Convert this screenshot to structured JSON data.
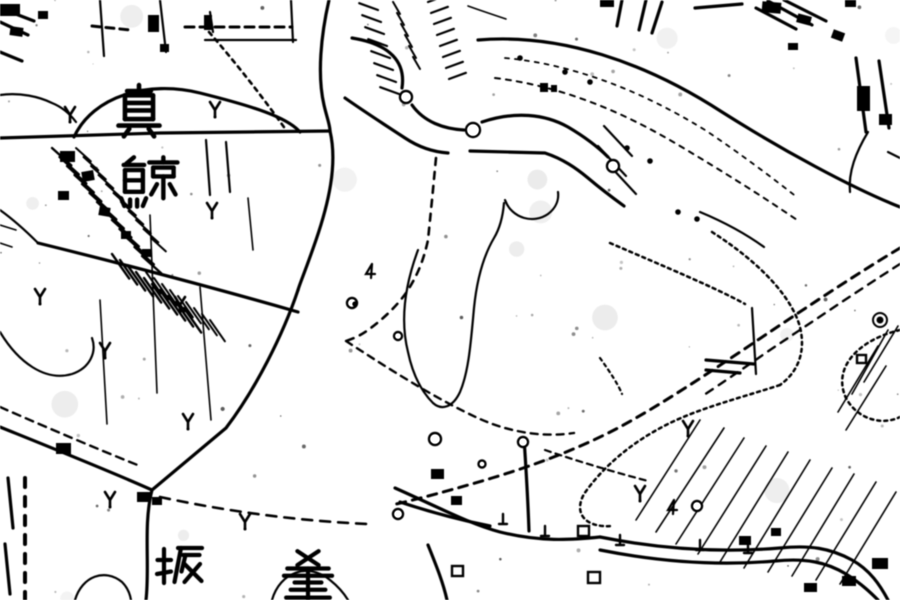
{
  "map": {
    "type": "scanned-monochrome-topographic-map",
    "background": "#ffffff",
    "ink": "#1b1b1b",
    "labels": [
      {
        "text": "眞",
        "x": 112,
        "y": 84,
        "size": 54,
        "w": 4.6,
        "strokes": [
          [
            50,
            2,
            50,
            13
          ],
          [
            28,
            13,
            72,
            13
          ],
          [
            24,
            21,
            76,
            21
          ],
          [
            24,
            21,
            24,
            65
          ],
          [
            76,
            21,
            76,
            65
          ],
          [
            28,
            35,
            72,
            35
          ],
          [
            28,
            49,
            72,
            49
          ],
          [
            24,
            65,
            76,
            65
          ],
          [
            12,
            77,
            88,
            77
          ],
          [
            32,
            83,
            22,
            97
          ],
          [
            68,
            83,
            78,
            97
          ]
        ]
      },
      {
        "text": "鯨",
        "x": 116,
        "y": 156,
        "size": 64,
        "w": 4.4,
        "strokes": [
          [
            28,
            2,
            16,
            12
          ],
          [
            12,
            14,
            44,
            14
          ],
          [
            14,
            22,
            14,
            56
          ],
          [
            42,
            22,
            42,
            56
          ],
          [
            14,
            22,
            42,
            22
          ],
          [
            14,
            38,
            42,
            38
          ],
          [
            14,
            56,
            42,
            56
          ],
          [
            8,
            66,
            13,
            78
          ],
          [
            22,
            68,
            22,
            79
          ],
          [
            33,
            68,
            33,
            79
          ],
          [
            47,
            66,
            42,
            78
          ],
          [
            52,
            10,
            96,
            10
          ],
          [
            74,
            2,
            74,
            10
          ],
          [
            58,
            18,
            90,
            18
          ],
          [
            58,
            18,
            58,
            32
          ],
          [
            90,
            18,
            90,
            32
          ],
          [
            58,
            32,
            90,
            32
          ],
          [
            74,
            32,
            74,
            66
          ],
          [
            64,
            44,
            55,
            60
          ],
          [
            84,
            44,
            93,
            60
          ]
        ]
      },
      {
        "text": "坂",
        "x": 156,
        "y": 543,
        "size": 50,
        "w": 4.2,
        "strokes": [
          [
            16,
            12,
            16,
            80
          ],
          [
            3,
            34,
            30,
            34
          ],
          [
            2,
            62,
            30,
            57
          ],
          [
            44,
            10,
            92,
            10
          ],
          [
            50,
            10,
            37,
            78
          ],
          [
            54,
            24,
            87,
            24
          ],
          [
            59,
            24,
            51,
            57
          ],
          [
            55,
            40,
            91,
            76
          ],
          [
            88,
            42,
            57,
            78
          ]
        ]
      },
      {
        "text": "釜",
        "x": 280,
        "y": 550,
        "size": 56,
        "w": 4.2,
        "strokes": [
          [
            31,
            2,
            69,
            27
          ],
          [
            69,
            2,
            31,
            27
          ],
          [
            13,
            33,
            87,
            33
          ],
          [
            50,
            33,
            50,
            88
          ],
          [
            7,
            46,
            93,
            46
          ],
          [
            26,
            58,
            74,
            58
          ],
          [
            19,
            71,
            81,
            71
          ],
          [
            11,
            85,
            89,
            85
          ]
        ]
      }
    ],
    "mulberry_symbols": [
      [
        70,
        114
      ],
      [
        215,
        109
      ],
      [
        212,
        210
      ],
      [
        40,
        296
      ],
      [
        105,
        350
      ],
      [
        180,
        304
      ],
      [
        188,
        421
      ],
      [
        110,
        499
      ],
      [
        245,
        521
      ],
      [
        640,
        493
      ],
      [
        688,
        428
      ]
    ],
    "circle_symbols": [
      [
        406,
        97,
        6
      ],
      [
        473,
        130,
        7
      ],
      [
        613,
        166,
        6
      ],
      [
        352,
        303,
        5
      ],
      [
        398,
        336,
        4
      ],
      [
        435,
        439,
        6
      ],
      [
        523,
        442,
        5
      ],
      [
        482,
        464,
        3.5
      ],
      [
        398,
        514,
        5
      ],
      [
        697,
        506,
        5
      ]
    ],
    "ring_dot_symbols": [
      [
        880,
        320
      ]
    ],
    "dot_symbols": [
      [
        678,
        212
      ],
      [
        697,
        219
      ],
      [
        650,
        161
      ],
      [
        545,
        88
      ],
      [
        355,
        304
      ],
      [
        520,
        58
      ],
      [
        565,
        72
      ],
      [
        590,
        82
      ],
      [
        627,
        148
      ]
    ],
    "square_symbols": [
      [
        578,
        526,
        11,
        10
      ],
      [
        588,
        572,
        12,
        11
      ],
      [
        452,
        566,
        11,
        10
      ],
      [
        857,
        355,
        9,
        8
      ]
    ],
    "four_symbols": [
      [
        370,
        272
      ],
      [
        672,
        508
      ]
    ],
    "tick_symbols": [
      [
        503,
        520
      ],
      [
        545,
        532
      ],
      [
        620,
        541
      ],
      [
        700,
        546
      ],
      [
        748,
        549
      ]
    ],
    "buildings": [
      [
        0,
        4,
        20,
        12,
        0
      ],
      [
        10,
        27,
        13,
        9,
        8
      ],
      [
        38,
        11,
        10,
        8,
        0
      ],
      [
        148,
        15,
        11,
        17,
        0
      ],
      [
        204,
        15,
        8,
        15,
        0
      ],
      [
        160,
        44,
        9,
        8,
        0
      ],
      [
        60,
        151,
        15,
        11,
        0
      ],
      [
        82,
        171,
        12,
        10,
        -10
      ],
      [
        58,
        191,
        11,
        9,
        0
      ],
      [
        99,
        207,
        11,
        9,
        10
      ],
      [
        121,
        231,
        10,
        8,
        0
      ],
      [
        142,
        249,
        9,
        8,
        0
      ],
      [
        56,
        443,
        15,
        11,
        0
      ],
      [
        600,
        0,
        14,
        7,
        0
      ],
      [
        845,
        0,
        11,
        7,
        0
      ],
      [
        762,
        2,
        19,
        11,
        5
      ],
      [
        797,
        15,
        14,
        9,
        15
      ],
      [
        832,
        31,
        12,
        9,
        20
      ],
      [
        788,
        43,
        10,
        7,
        0
      ],
      [
        857,
        86,
        13,
        25,
        0
      ],
      [
        879,
        114,
        13,
        11,
        0
      ],
      [
        872,
        558,
        16,
        11,
        0
      ],
      [
        842,
        576,
        14,
        10,
        0
      ],
      [
        804,
        583,
        13,
        9,
        0
      ],
      [
        739,
        536,
        12,
        9,
        0
      ],
      [
        771,
        528,
        10,
        8,
        0
      ],
      [
        431,
        469,
        13,
        10,
        0
      ],
      [
        451,
        496,
        11,
        9,
        0
      ],
      [
        540,
        83,
        8,
        9,
        0
      ],
      [
        551,
        85,
        6,
        7,
        0
      ],
      [
        137,
        492,
        14,
        10,
        0
      ],
      [
        152,
        497,
        10,
        8,
        0
      ]
    ],
    "bold_paths": [
      "M0,138 L160,133 L330,131",
      "M329,0 C321,35 317,75 324,105 C327,118 330,125 330,131",
      "M330,131 C338,165 328,205 316,240 C305,272 300,283 298,290",
      "M298,290 C283,335 255,390 226,428 L152,490",
      "M152,490 C112,472 52,448 0,427",
      "M152,490 C143,525 150,565 146,600",
      "M74,137 C93,96 148,80 200,93 C252,106 287,117 300,132",
      "M38,243 C115,262 215,288 298,312",
      "M478,40 C560,33 645,62 722,112 C782,150 852,188 900,207",
      "M470,151 L545,153 C563,159 576,168 588,178 C601,189 613,198 624,206",
      "M482,122 C515,111 545,114 568,127 C585,137 598,147 608,157",
      "M345,98 C365,112 385,125 405,138 C420,148 434,152 448,153",
      "M412,105 C424,122 444,129 464,130",
      "M352,38 C390,44 406,62 402,88",
      "M395,488 C440,508 470,524 500,532 C540,542 570,540 600,537",
      "M600,537 C660,549 720,553 780,548 C810,545 830,548 852,560 C870,570 880,585 888,600",
      "M600,550 C660,562 718,566 775,561 C806,558 826,562 846,574 C862,584 872,594 878,600",
      "M524,438 C526,468 528,502 529,531",
      "M428,545 C436,565 443,582 447,600",
      "M400,502 C430,512 460,520 490,526",
      "M706,360 L754,364",
      "M706,370 L740,373",
      "M0,8 L34,21",
      "M0,22 L28,35",
      "M0,52 L22,61",
      "M622,0 L617,26",
      "M646,0 L639,30",
      "M662,2 L652,33",
      "M695,8 L742,4",
      "M756,8 L796,29",
      "M768,1 L812,25",
      "M784,0 L826,21",
      "M856,58 L866,132",
      "M879,61 L889,128",
      "M8,478 L13,528",
      "M5,544 L10,594"
    ],
    "mid_paths": [
      "M205,40 L296,40",
      "M291,0 L293,42",
      "M0,332 C18,362 45,382 72,374 C90,368 97,352 92,338",
      "M75,600 C82,576 105,568 122,582 C128,588 130,594 131,600",
      "M272,600 C280,572 308,562 330,580 C340,588 345,595 348,600",
      "M0,210 C14,220 27,232 38,243",
      "M868,132 C856,152 848,172 850,192",
      "M700,212 C724,222 746,234 764,247",
      "M752,308 L756,374",
      "M206,140 L210,195",
      "M226,142 L230,192",
      "M418,250 C405,285 400,320 408,352 C413,376 422,392 433,403 C442,411 453,407 460,392 C469,371 471,340 474,308 C477,278 484,255 494,238 C500,228 503,215 504,203",
      "M505,200 C512,219 534,224 548,214 C556,208 559,200 558,192",
      "M0,95 C20,92 40,97 52,103 C62,107 70,114 76,122",
      "M100,0 L104,56",
      "M160,0 L166,52",
      "M210,12 L213,32",
      "M888,152 L900,158",
      "M604,126 L632,156 M598,146 L626,176 M610,166 L636,194"
    ],
    "thin_paths": [
      "M150,215 L157,393",
      "M200,287 L211,420",
      "M100,300 L107,424",
      "M248,198 L253,250",
      "M468,6 C482,11 494,15 506,19",
      "M0,225 L16,230 M0,243 L12,247",
      "M636,520 L700,420 M656,532 L724,428 M676,544 L744,438 M698,554 L766,446 M720,562 L788,452 M744,568 L810,460 M768,572 L832,468 M792,576 L854,474 M816,580 L876,482 M840,584 L896,492",
      "M852,394 L888,330 M838,412 L878,346 M864,382 L898,326 M846,430 L886,366"
    ],
    "dashed_paths": [
      {
        "d": "M900,248 C850,278 795,315 740,352 C695,382 655,408 618,428 C576,450 532,466 492,478 C452,490 418,499 392,505",
        "w": 3,
        "dash": "9 7"
      },
      {
        "d": "M900,264 C856,292 812,322 770,350 C744,368 722,383 704,395",
        "w": 2.4,
        "dash": "8 7"
      },
      {
        "d": "M160,497 C230,512 300,521 368,524",
        "w": 2.6,
        "dash": "10 8"
      },
      {
        "d": "M436,158 L432,200 L428,240 C423,263 416,278 406,293 C396,307 382,320 368,330 C360,336 352,339 346,341",
        "w": 2.6,
        "dash": "7 7"
      },
      {
        "d": "M346,341 C395,373 442,402 480,419 C514,434 547,437 574,433",
        "w": 2.4,
        "dash": "7 6"
      },
      {
        "d": "M209,32 C235,62 262,96 286,130",
        "w": 2.6,
        "dash": "4 5"
      },
      {
        "d": "M185,27 L292,27",
        "w": 3,
        "dash": "9 6"
      },
      {
        "d": "M92,26 L130,30",
        "w": 3,
        "dash": "8 6"
      },
      {
        "d": "M0,407 C48,428 95,448 140,466",
        "w": 2.4,
        "dash": "8 6"
      },
      {
        "d": "M495,78 C560,86 620,110 680,146 C722,171 762,196 800,222",
        "w": 2,
        "dash": "5 6"
      },
      {
        "d": "M505,58 C572,64 640,90 705,130 C738,152 770,176 798,198",
        "w": 1.8,
        "dash": "4 6"
      },
      {
        "d": "M25,478 L25,600",
        "w": 4,
        "dash": "9 10"
      },
      {
        "d": "M545,450 C580,462 614,472 648,481",
        "w": 2.2,
        "dash": "6 5"
      },
      {
        "d": "M610,243 C668,268 716,288 745,304",
        "w": 2.5,
        "dash": "3 4"
      },
      {
        "d": "M712,232 C762,264 792,298 800,327 C806,352 798,372 780,385",
        "w": 2.5,
        "dash": "3 4"
      },
      {
        "d": "M780,385 C740,398 700,408 668,424 C630,443 602,468 584,494 C573,514 586,528 612,526",
        "w": 2.5,
        "dash": "3 4"
      },
      {
        "d": "M900,330 C858,340 832,368 846,398 C857,419 882,426 900,417",
        "w": 2.5,
        "dash": "3 4"
      },
      {
        "d": "M600,358 C610,372 618,384 622,394",
        "w": 2.2,
        "dash": "3 4"
      }
    ],
    "hatch_groups": [
      {
        "x": 52,
        "y": 148,
        "dx": 7.5,
        "dy": 9,
        "n": 13,
        "len": 26,
        "ang": 42,
        "w": 2.4
      },
      {
        "x": 76,
        "y": 148,
        "dx": 7.5,
        "dy": 9,
        "n": 11,
        "len": 20,
        "ang": 42,
        "w": 2
      },
      {
        "x": 112,
        "y": 254,
        "dx": 8,
        "dy": 6,
        "n": 10,
        "len": 30,
        "ang": 55,
        "w": 2.4
      },
      {
        "x": 146,
        "y": 272,
        "dx": 8,
        "dy": 6,
        "n": 9,
        "len": 26,
        "ang": 55,
        "w": 2
      },
      {
        "x": 378,
        "y": 10,
        "dx": 3,
        "dy": 12,
        "n": 8,
        "len": 20,
        "ang": 200,
        "w": 2.2
      },
      {
        "x": 428,
        "y": 2,
        "dx": 3,
        "dy": 11,
        "n": 8,
        "len": 18,
        "ang": -20,
        "w": 2.2
      },
      {
        "x": 400,
        "y": 14,
        "dx": 4,
        "dy": 11,
        "n": 6,
        "len": 14,
        "ang": 240,
        "w": 2
      }
    ]
  }
}
